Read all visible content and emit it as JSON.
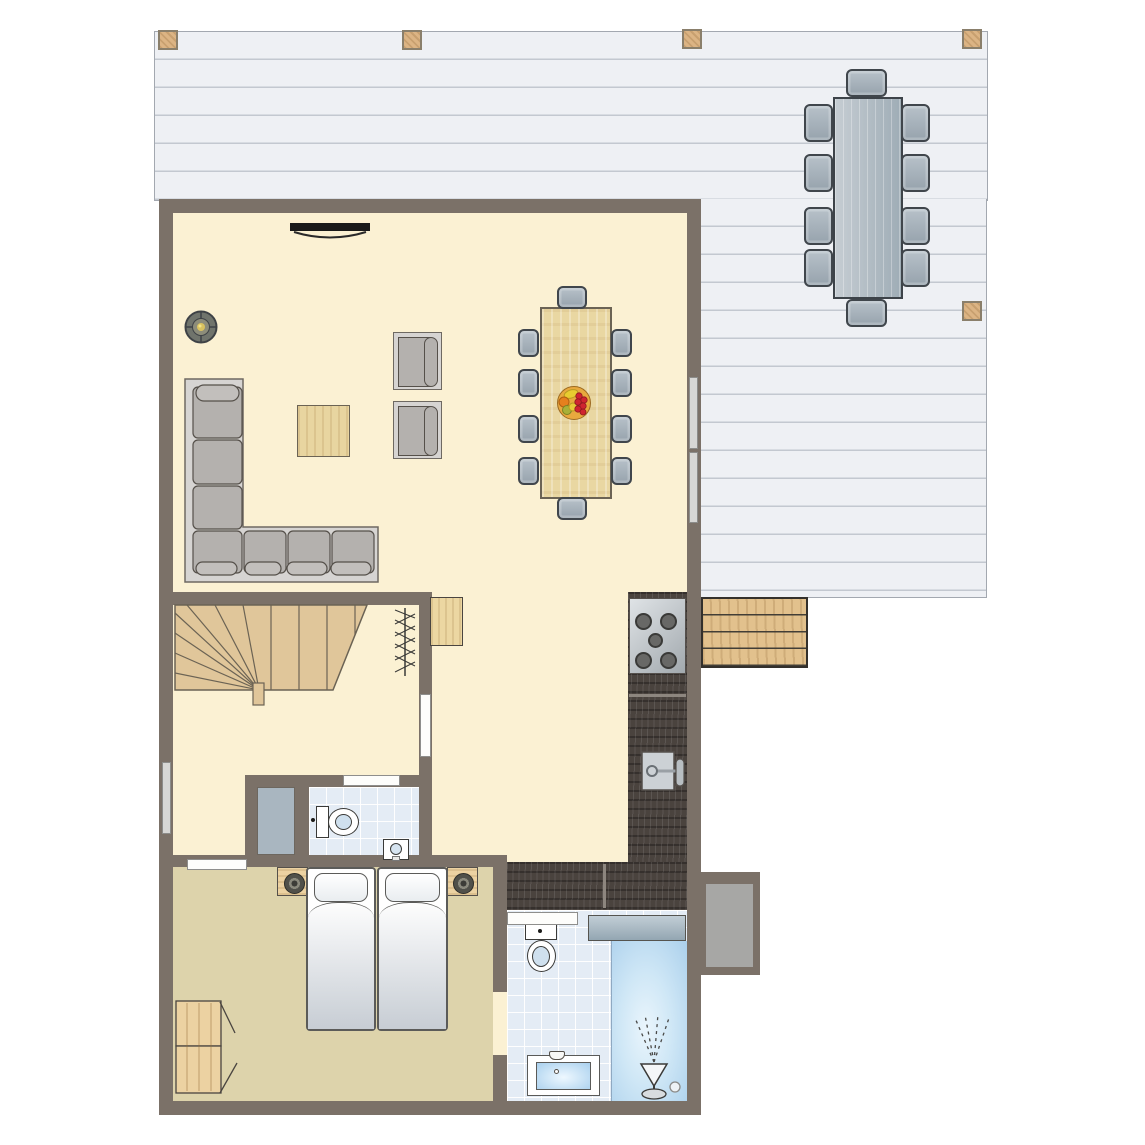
{
  "scene": {
    "kind": "holiday-home floor plan, top-down view, no text labels",
    "palette": {
      "wall": "#7b7168",
      "floor_main": "#fbf1d3",
      "floor_bedroom": "#ddd3ab",
      "tile": "#e4ecf5",
      "deck": "#eef0f4",
      "deck_line": "#c3c8d0",
      "wood_light": "#e0c69a",
      "post_wood": "#dcb484",
      "table_wood": "#e9d7a2",
      "counter_dark": "#4a433e",
      "sofa_gray": "#b4b1ae",
      "chair_gray_blue": "#a9b4bd",
      "shower_blue": "#abd0ec",
      "fruit_red": "#cf2430"
    }
  },
  "outdoor": {
    "deck": {
      "plank_direction": "horizontal",
      "posts": 5
    },
    "patio_dining": {
      "tables": 1,
      "chairs": 10
    },
    "bench_planks": 4,
    "side_pad": 1
  },
  "living_room": {
    "wall_tv": 1,
    "wood_stove": 1,
    "corner_sofa_cushions": 7,
    "armchairs": 2,
    "coffee_table": 1,
    "dining": {
      "tables": 1,
      "chairs": 10,
      "fruit_bowl": 1
    }
  },
  "kitchen": {
    "hob_burners": 5,
    "sink": 1,
    "counter_sections": 2
  },
  "hall": {
    "staircase": 1,
    "coat_rack": 1,
    "cabinet": 1,
    "closet": 1,
    "toilet_room": {
      "toilet": 1,
      "hand_basin": 1
    }
  },
  "bedroom": {
    "beds": 2,
    "nightstands": 2,
    "lamps": 2,
    "wardrobe_doors": 2
  },
  "bathroom": {
    "toilet": 1,
    "vanity_sink": 1,
    "walk_in_shower": 1,
    "radiator": 1
  },
  "openings": {
    "doors": 4,
    "windows": 3
  }
}
